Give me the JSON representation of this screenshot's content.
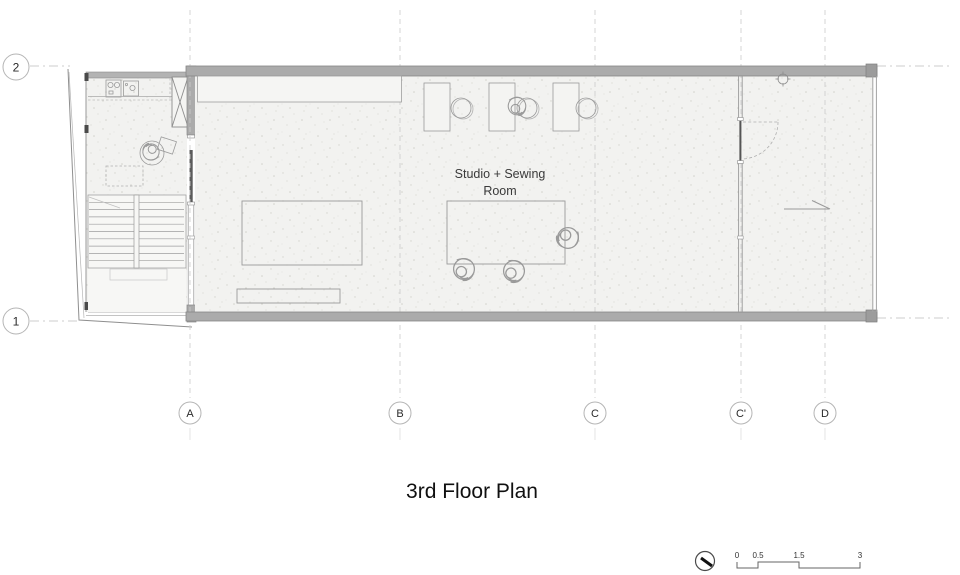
{
  "document": {
    "title": "3rd Floor Plan"
  },
  "grid": {
    "columns": [
      "A",
      "B",
      "C",
      "C'",
      "D"
    ],
    "rows": [
      "2",
      "1"
    ]
  },
  "rooms": {
    "studio": {
      "label_line1": "Studio + Sewing",
      "label_line2": "Room"
    }
  },
  "scale_bar": {
    "ticks": [
      "0",
      "0.5",
      "1.5",
      "3"
    ]
  },
  "colors": {
    "wall_fill": "#ababab",
    "wall_edge": "#878787",
    "floor_fill": "#f2f2f0",
    "furniture_line": "#9a9a9a",
    "grid_line": "#cccccc",
    "text_primary": "#101010",
    "text_secondary": "#3a3a3a"
  },
  "icons": {
    "north_arrow": "north-arrow-icon",
    "door_swing": "door-swing-icon",
    "stairs": "stairs-icon",
    "elevator_shaft": "shaft-x-icon",
    "ceiling_fixture": "column-symbol-icon"
  }
}
